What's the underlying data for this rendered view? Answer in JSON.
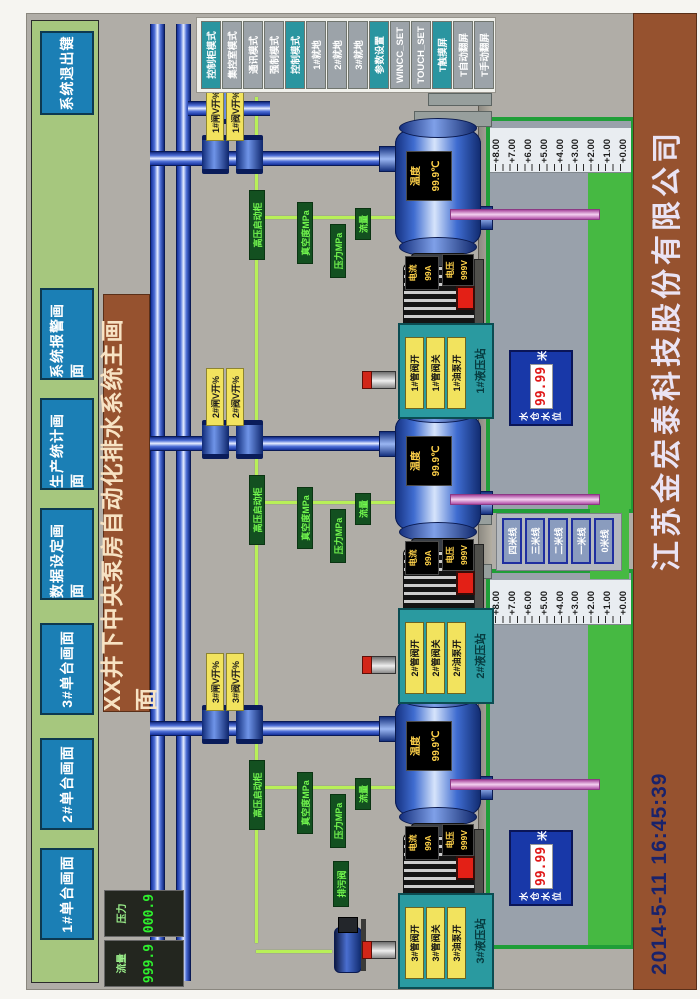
{
  "title": "XX井下中央泵房自动化排水系统主画面",
  "menu": {
    "items": [
      "1#单台画面",
      "2#单台画面",
      "3#单台画面",
      "数据设定画面",
      "生产统计画面",
      "系统报警画面"
    ],
    "exit": "系统退出键"
  },
  "gauges": [
    {
      "label": "流量",
      "value": "999.9"
    },
    {
      "label": "压力",
      "value": "000.9"
    }
  ],
  "right_panel": {
    "buttons": [
      {
        "label": "控制柜模式",
        "style": "teal"
      },
      {
        "label": "集控室模式",
        "style": "gray"
      },
      {
        "label": "通讯模式",
        "style": "gray"
      },
      {
        "label": "强制模式",
        "style": "gray"
      },
      {
        "label": "控制模式",
        "style": "teal"
      },
      {
        "label": "1#就地",
        "style": "gray"
      },
      {
        "label": "2#就地",
        "style": "gray"
      },
      {
        "label": "3#就地",
        "style": "gray"
      },
      {
        "label": "参数设置",
        "style": "teal"
      },
      {
        "label": "WINCC_SET",
        "style": "gray"
      },
      {
        "label": "TOUCH_SET",
        "style": "gray"
      },
      {
        "label": "T触摸屏",
        "style": "teal"
      },
      {
        "label": "T自动翻屏",
        "style": "gray"
      },
      {
        "label": "T手动翻屏",
        "style": "gray"
      }
    ]
  },
  "pumps": [
    {
      "id": "3#",
      "temp_label": "温度",
      "temp_value": "99.9℃",
      "current_label": "电流",
      "current_value": "99A",
      "volt_label": "电压",
      "volt_value": "999V",
      "valve_label_1": "3#闸V开%",
      "valve_label_2": "3#阀V开%",
      "hydraulic": {
        "title": "3#液压站",
        "buttons": [
          "3#管阀开",
          "3#管阀关",
          "3#油泵开"
        ]
      },
      "signal_labels": [
        "高压启动柜",
        "真空度MPa",
        "压力MPa",
        "流量"
      ]
    },
    {
      "id": "2#",
      "temp_label": "温度",
      "temp_value": "99.9℃",
      "current_label": "电流",
      "current_value": "99A",
      "volt_label": "电压",
      "volt_value": "999V",
      "valve_label_1": "2#闸V开%",
      "valve_label_2": "2#阀V开%",
      "hydraulic": {
        "title": "2#液压站",
        "buttons": [
          "2#管阀开",
          "2#管阀关",
          "2#油泵开"
        ]
      },
      "signal_labels": [
        "高压启动柜",
        "真空度MPa",
        "压力MPa",
        "流量"
      ]
    },
    {
      "id": "1#",
      "temp_label": "温度",
      "temp_value": "99.9℃",
      "current_label": "电流",
      "current_value": "99A",
      "volt_label": "电压",
      "volt_value": "999V",
      "valve_label_1": "1#闸V开%",
      "valve_label_2": "1#阀V开%",
      "hydraulic": {
        "title": "1#液压站",
        "buttons": [
          "1#管阀开",
          "1#管阀关",
          "1#油泵开"
        ]
      },
      "signal_labels": [
        "高压启动柜",
        "真空度MPa",
        "压力MPa",
        "流量"
      ]
    }
  ],
  "sumps": [
    {
      "scale_labels": [
        "+8.00",
        "+7.00",
        "+6.00",
        "+5.00",
        "+4.00",
        "+3.00",
        "+2.00",
        "+1.00",
        "+0.00"
      ],
      "readout": {
        "label_line1": "水仓",
        "label_line2": "水位",
        "value": "99.99",
        "unit": "米"
      }
    },
    {
      "scale_labels": [
        "+8.00",
        "+7.00",
        "+6.00",
        "+5.00",
        "+4.00",
        "+3.00",
        "+2.00",
        "+1.00",
        "+0.00"
      ],
      "readout": {
        "label_line1": "水仓",
        "label_line2": "水位",
        "value": "99.99",
        "unit": "米"
      }
    }
  ],
  "level_lines": {
    "buttons": [
      "四米线",
      "三米线",
      "二米线",
      "一米线",
      "0米线"
    ]
  },
  "misc": {
    "drain_label": "排污阀"
  },
  "footer": {
    "datetime": "2014-5-11  16:45:39",
    "company": "江苏金宏泰科技股份有限公司"
  },
  "colors": {
    "screen_gray": "#b0ada7",
    "bar_green": "#a6c77e",
    "button_blue": "#1b7fb5",
    "banner_brown": "#96522f",
    "pipe_blue": "#2244cc",
    "suction_pink": "#e9a0e0",
    "signal_lime": "#b8f058",
    "label_green_bg": "#135020",
    "label_green_text": "#72f74e",
    "label_yellow_bg": "#f2e35e",
    "panel_teal": "#2a9aa0",
    "readout_blue": "#1838a8",
    "digit_red": "#e01818",
    "water_green": "#46b942",
    "alarm_red": "#e32016"
  }
}
